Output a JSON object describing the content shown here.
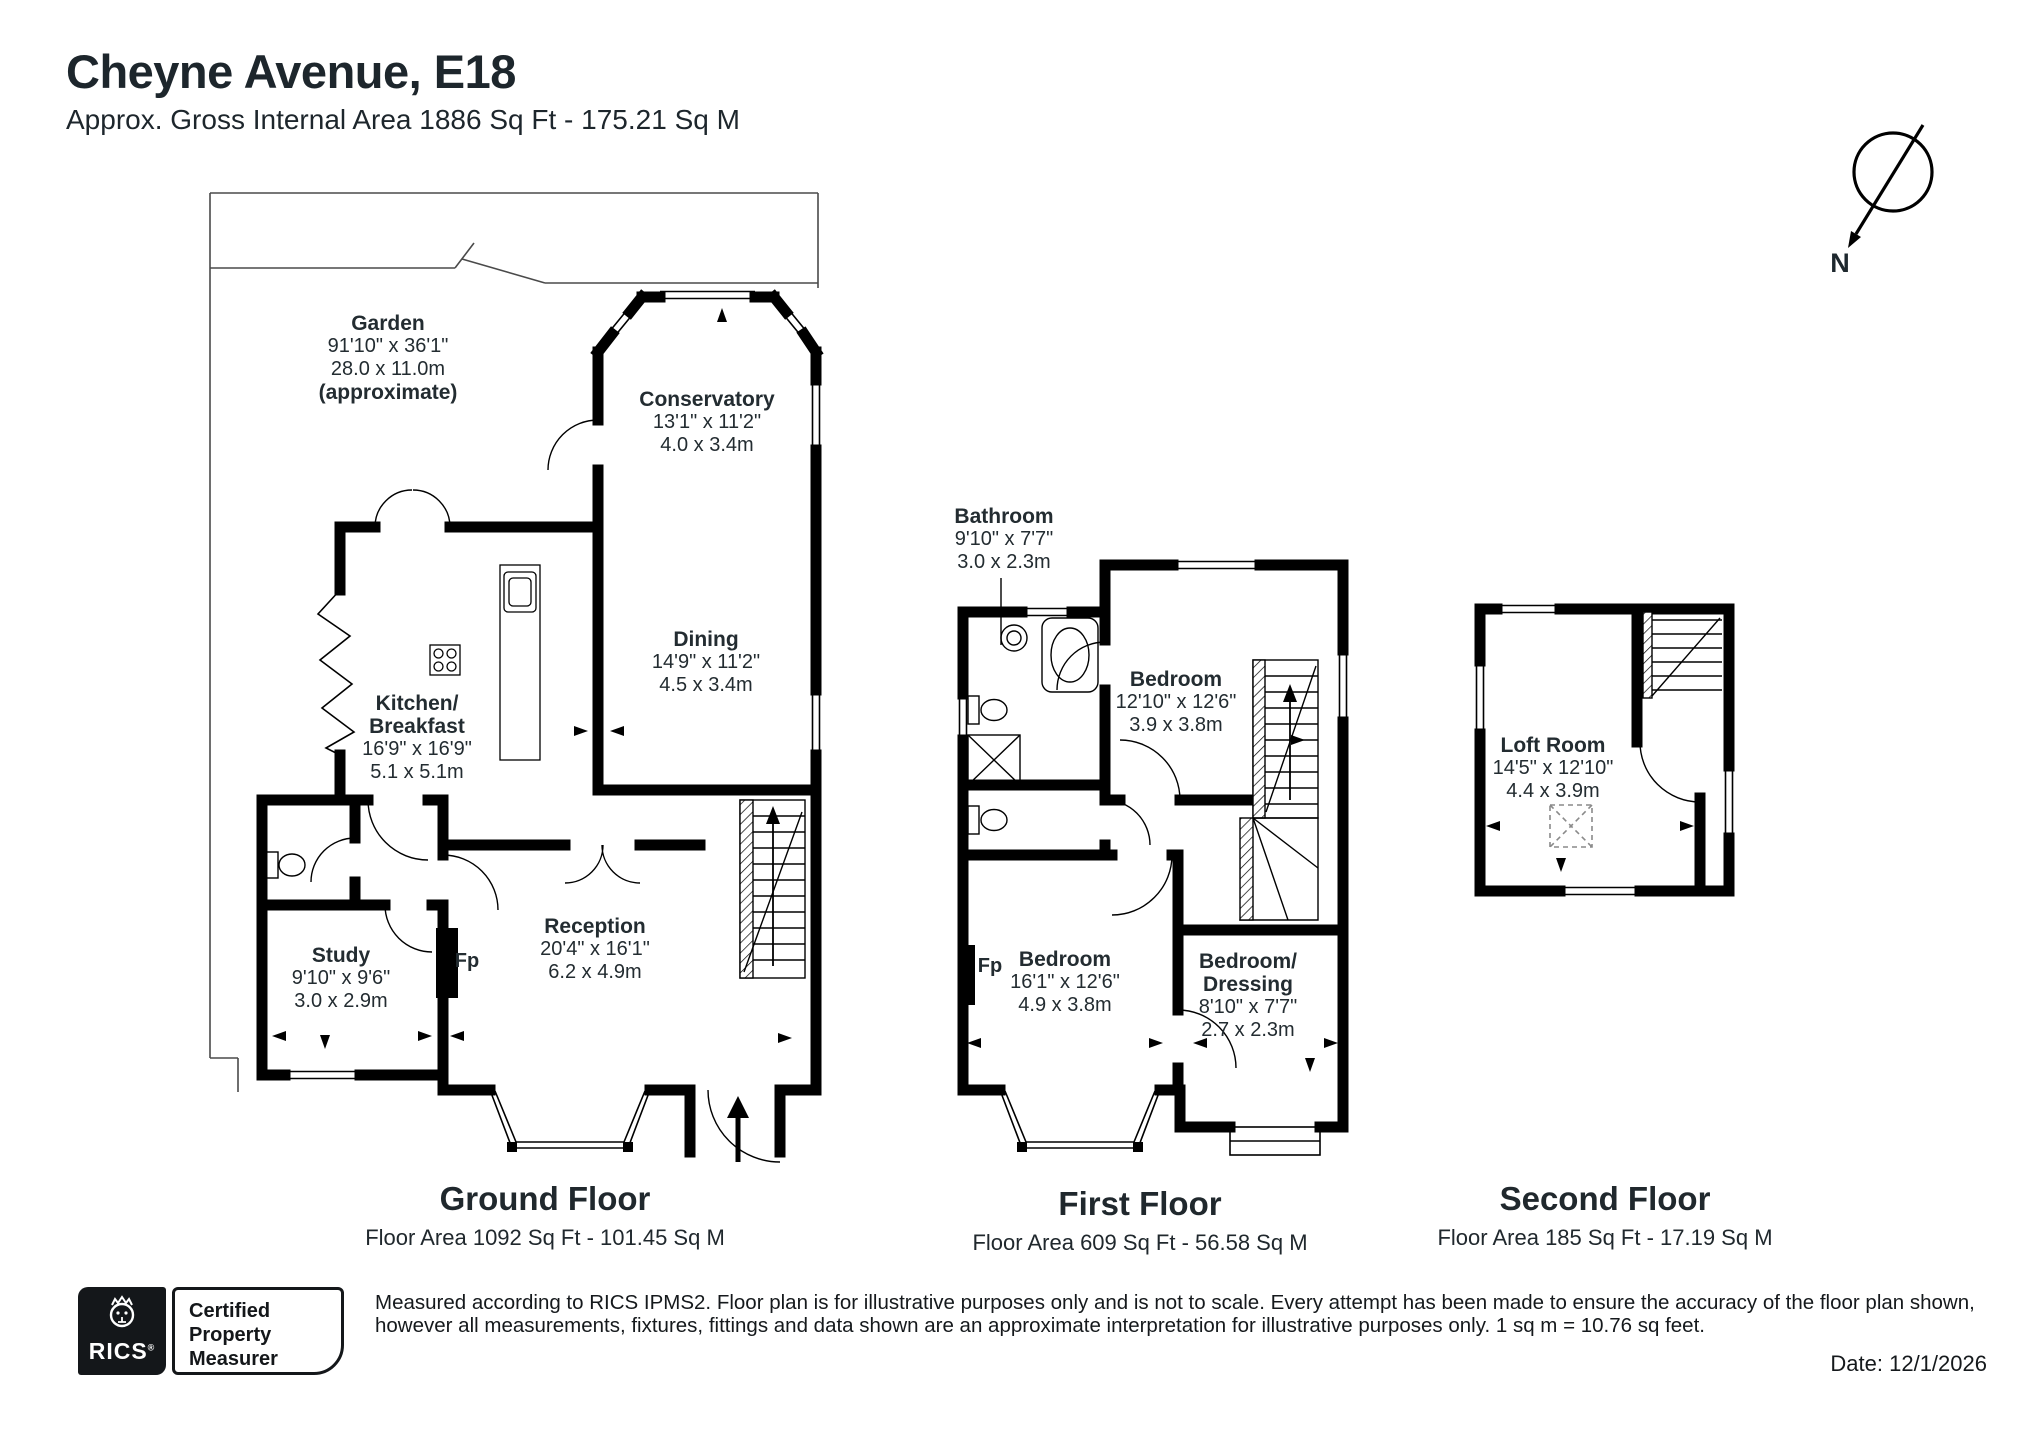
{
  "header": {
    "title": "Cheyne Avenue, E18",
    "subtitle": "Approx. Gross Internal Area 1886 Sq Ft - 175.21 Sq M"
  },
  "compass": {
    "north_label": "N"
  },
  "floors": {
    "ground": {
      "caption": "Ground Floor",
      "area": "Floor Area 1092 Sq Ft - 101.45 Sq M",
      "rooms": {
        "garden": {
          "name": "Garden",
          "imperial": "91'10\" x 36'1\"",
          "metric": "28.0 x 11.0m",
          "note": "(approximate)"
        },
        "conservatory": {
          "name": "Conservatory",
          "imperial": "13'1\" x 11'2\"",
          "metric": "4.0 x 3.4m"
        },
        "kitchen": {
          "name": "Kitchen/",
          "name2": "Breakfast",
          "imperial": "16'9\" x 16'9\"",
          "metric": "5.1 x 5.1m"
        },
        "dining": {
          "name": "Dining",
          "imperial": "14'9\" x 11'2\"",
          "metric": "4.5 x 3.4m"
        },
        "reception": {
          "name": "Reception",
          "imperial": "20'4\" x 16'1\"",
          "metric": "6.2 x 4.9m"
        },
        "study": {
          "name": "Study",
          "imperial": "9'10\" x 9'6\"",
          "metric": "3.0 x 2.9m"
        },
        "fireplace": "Fp"
      }
    },
    "first": {
      "caption": "First Floor",
      "area": "Floor Area 609 Sq Ft - 56.58 Sq M",
      "rooms": {
        "bathroom": {
          "name": "Bathroom",
          "imperial": "9'10\" x 7'7\"",
          "metric": "3.0 x 2.3m"
        },
        "bedroom1": {
          "name": "Bedroom",
          "imperial": "12'10\" x 12'6\"",
          "metric": "3.9 x 3.8m"
        },
        "bedroom2": {
          "name": "Bedroom",
          "imperial": "16'1\" x 12'6\"",
          "metric": "4.9 x 3.8m"
        },
        "dressing": {
          "name": "Bedroom/",
          "name2": "Dressing",
          "imperial": "8'10\" x 7'7\"",
          "metric": "2.7 x 2.3m"
        },
        "fireplace": "Fp"
      }
    },
    "second": {
      "caption": "Second Floor",
      "area": "Floor Area 185 Sq Ft - 17.19 Sq M",
      "rooms": {
        "loft": {
          "name": "Loft Room",
          "imperial": "14'5\" x 12'10\"",
          "metric": "4.4 x 3.9m"
        }
      }
    }
  },
  "footer": {
    "logo": {
      "brand": "RICS",
      "reg": "®",
      "line1": "Certified",
      "line2": "Property",
      "line3": "Measurer"
    },
    "disclaimer_lines": [
      "Measured according to RICS IPMS2. Floor plan is for illustrative purposes only and is not to scale. Every attempt has been made to ensure the accuracy of the floor plan shown,",
      "however all measurements, fixtures, fittings and data shown are an approximate interpretation for illustrative purposes only. 1 sq m = 10.76 sq feet."
    ],
    "date": "Date: 12/1/2026"
  },
  "colors": {
    "wall": "#000000",
    "text": "#1e282e",
    "garden_line": "#4a4a4a"
  }
}
